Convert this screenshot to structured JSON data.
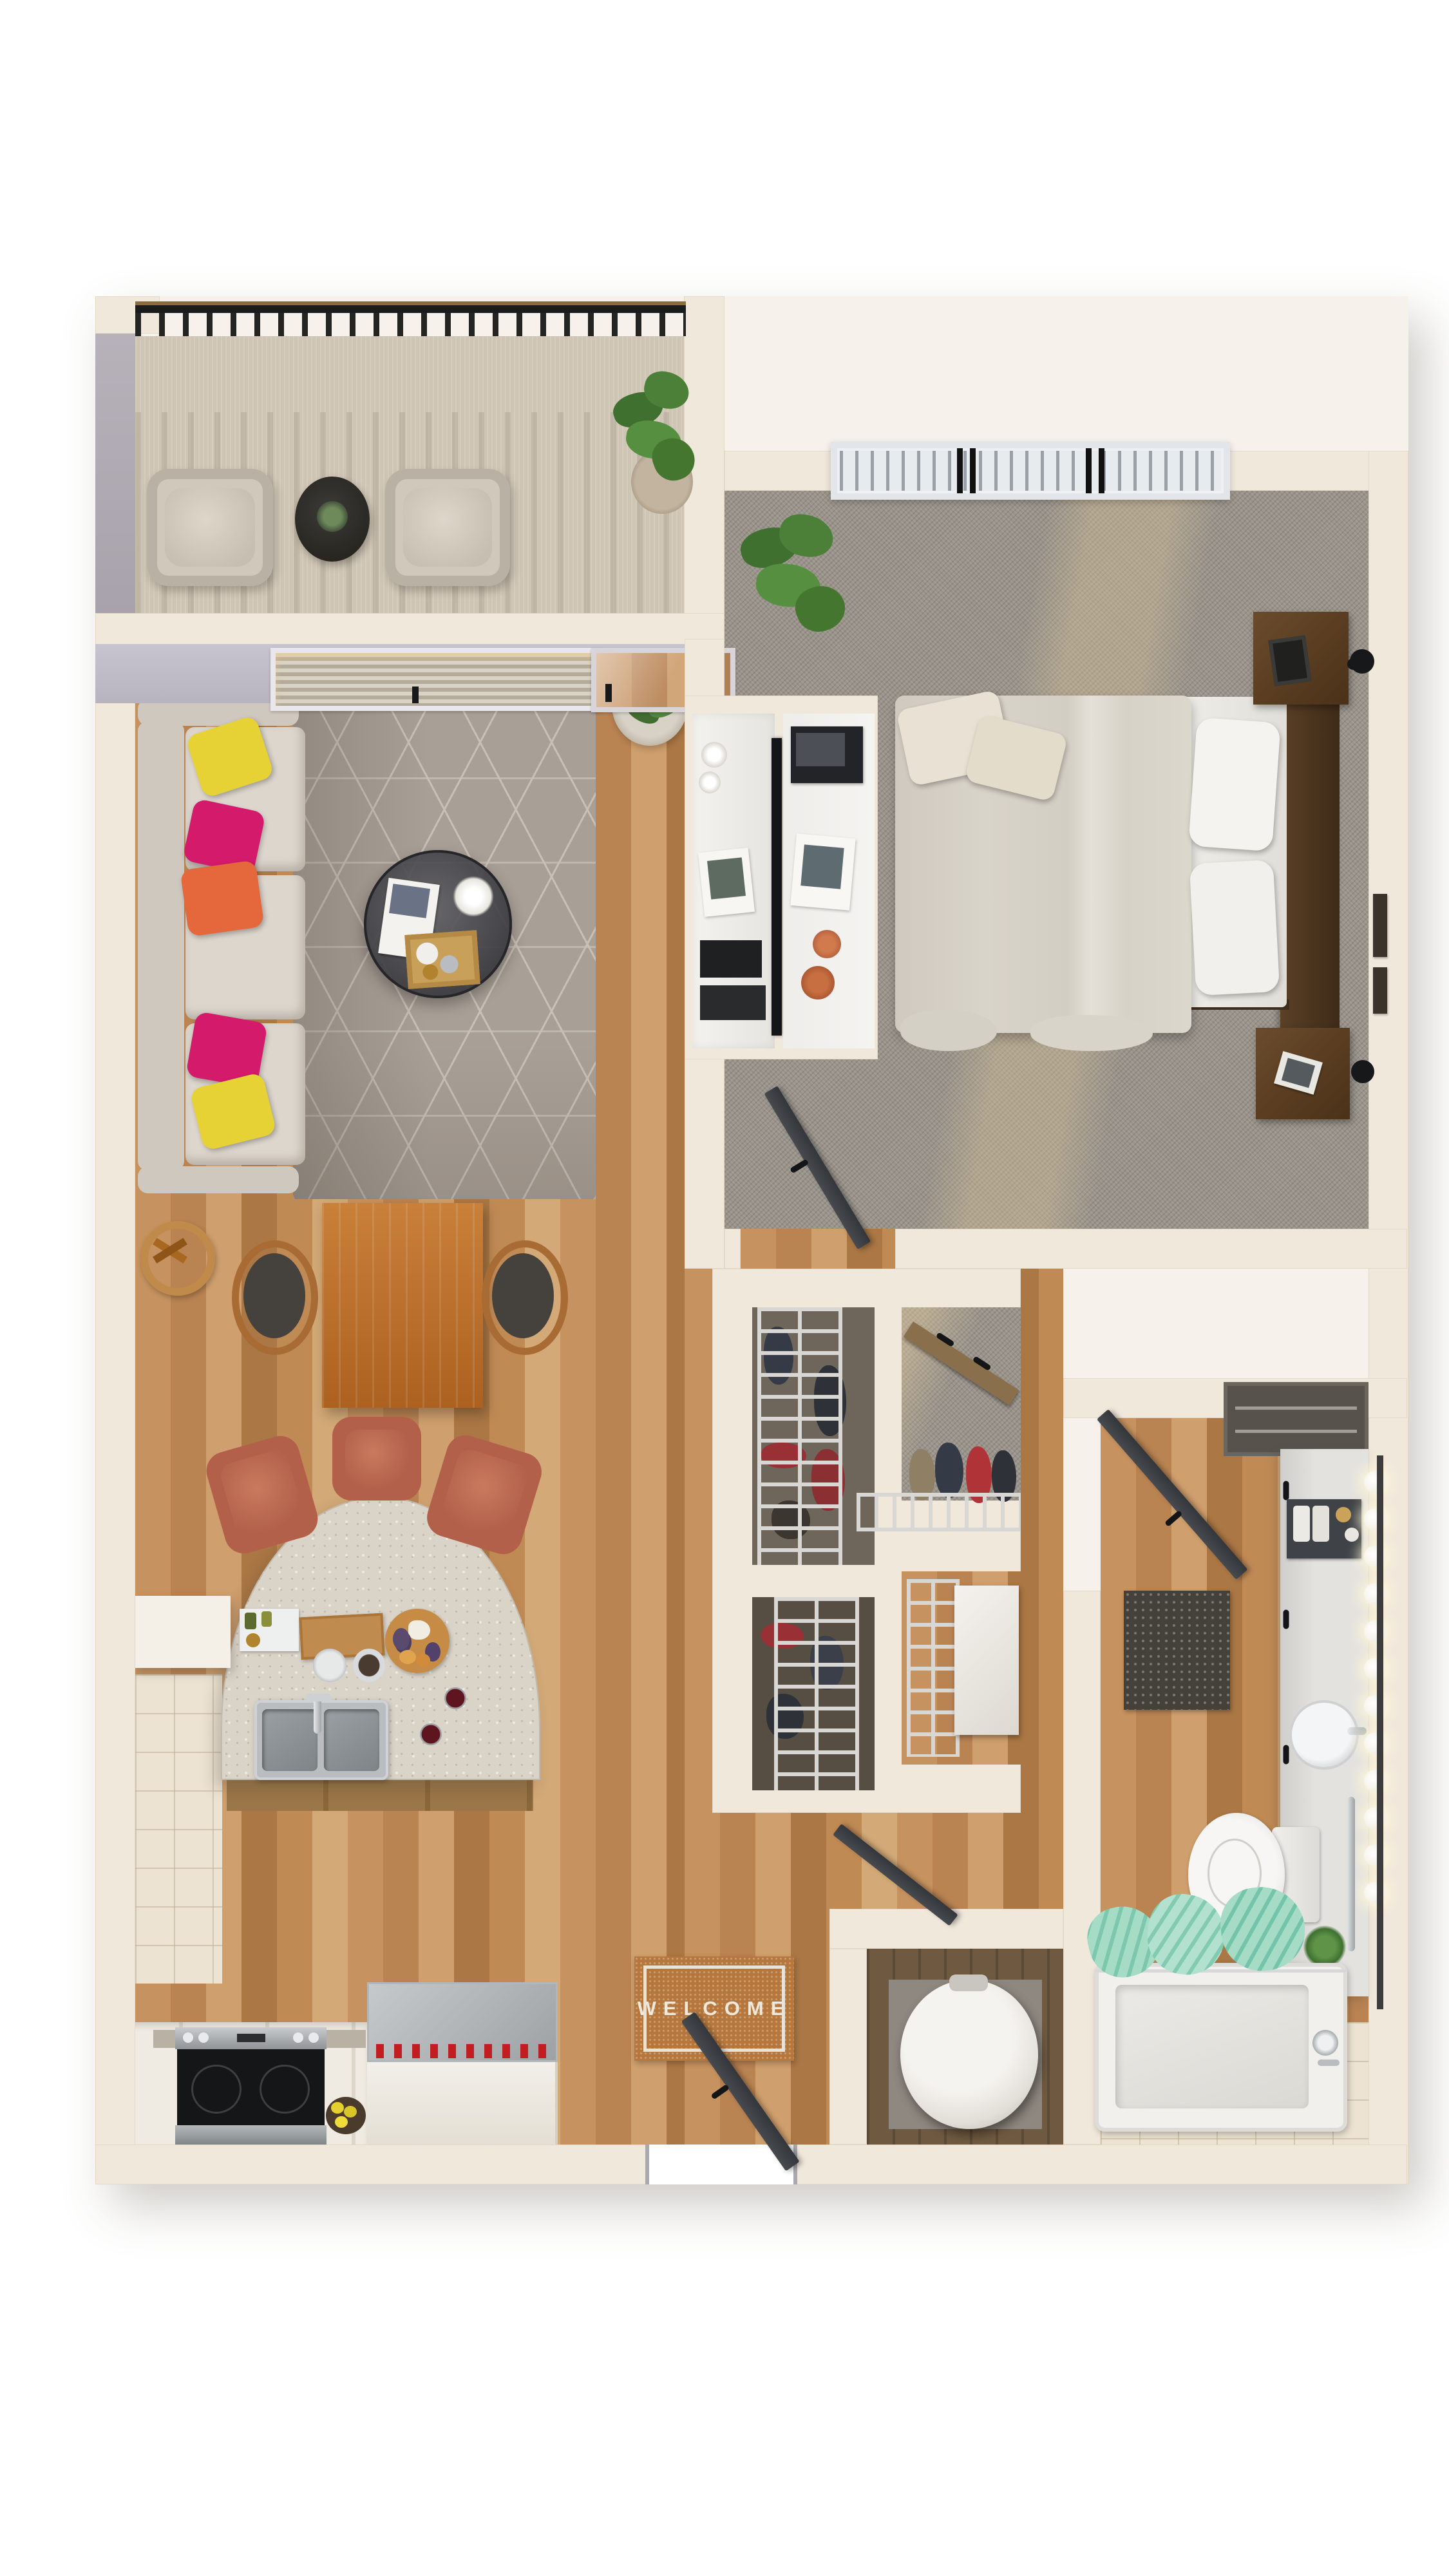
{
  "scene": {
    "title": "one-bedroom apartment 3D floor plan",
    "view": "top-down dollhouse render",
    "background": "#ffffff"
  },
  "entry": {
    "welcome_mat_text": "WELCOME"
  },
  "palette": {
    "wall_cream": "#f1e8dc",
    "wall_face_gray": "#c8c4cf",
    "wood_floor": "#c2905d",
    "carpet_gray": "#99938a",
    "balcony_concrete": "#cfc5b4",
    "rug_gray": "#a89f96",
    "sofa_taupe": "#d6d0c7",
    "pillow_yellow": "#e6d234",
    "pillow_magenta": "#d41a6b",
    "pillow_orange": "#e5673c",
    "dining_table_wood": "#c0742e",
    "stool_rust": "#b2604a",
    "counter_terrazzo": "#d9d3c8",
    "sink_steel": "#9aa0a4",
    "bed_duvet": "#d9d4ca",
    "nightstand_wood": "#5b4026",
    "door_charcoal": "#3b3d40",
    "railing_black": "#1a1b1d",
    "towel_mint": "#a6dcc6",
    "welcome_mat_coir": "#b5773e",
    "fridge_red_bottles": "#c21d20",
    "water_heater_white": "#ebe8e3"
  },
  "rooms": [
    {
      "name": "balcony",
      "furniture": [
        "wicker-armchair",
        "wicker-armchair",
        "round-side-table",
        "potted-plant",
        "metal-railing"
      ]
    },
    {
      "name": "living-room",
      "furniture": [
        "sofa",
        "throw-pillows",
        "geometric-rug",
        "round-coffee-table",
        "cactus-plant",
        "tv-console",
        "wall-art"
      ]
    },
    {
      "name": "dining-area",
      "furniture": [
        "wood-dining-table",
        "wishbone-chair",
        "wishbone-chair"
      ]
    },
    {
      "name": "kitchen",
      "furniture": [
        "curved-peninsula-counter",
        "double-sink",
        "bar-stool",
        "bar-stool",
        "bar-stool",
        "range",
        "refrigerator",
        "charcuterie-board",
        "wine-glasses",
        "lemon-bowl"
      ]
    },
    {
      "name": "bedroom",
      "furniture": [
        "bed",
        "pillows",
        "headboard",
        "nightstand",
        "nightstand",
        "wall-sconce",
        "desk",
        "air-vent",
        "plant"
      ]
    },
    {
      "name": "walk-in-closet",
      "furniture": [
        "wire-shoe-rack",
        "wire-shoe-rack",
        "wire-shoe-rack",
        "hanging-rail",
        "shelf",
        "storage-box"
      ]
    },
    {
      "name": "bathroom",
      "furniture": [
        "vanity-counter",
        "round-sink",
        "vanity-globe-lights",
        "toilet",
        "bathtub",
        "shower-curtain-mint",
        "shag-mat",
        "towel-bar",
        "linen-niche"
      ]
    },
    {
      "name": "utility-closet",
      "furniture": [
        "water-heater"
      ]
    },
    {
      "name": "entry",
      "furniture": [
        "welcome-mat",
        "front-door"
      ]
    }
  ]
}
